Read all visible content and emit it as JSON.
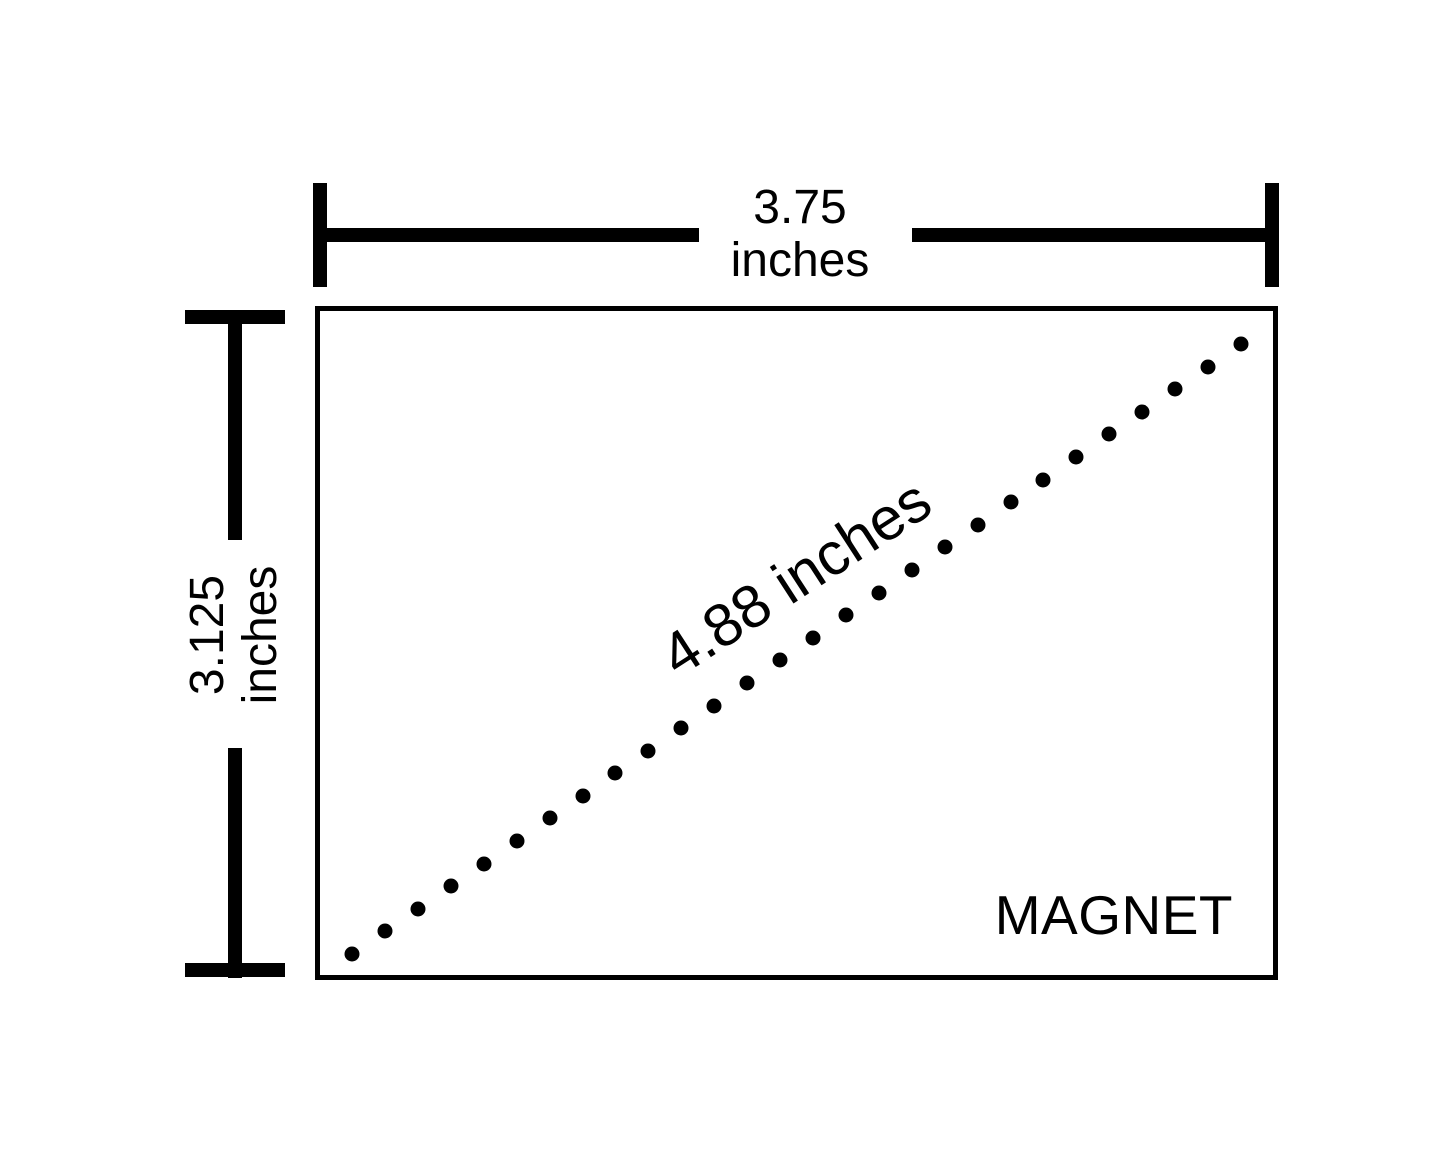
{
  "diagram": {
    "object_label": "MAGNET",
    "width_dimension": {
      "value": "3.75",
      "unit": "inches"
    },
    "height_dimension": {
      "value": "3.125",
      "unit": "inches"
    },
    "diagonal_dimension": {
      "label": "4.88 inches"
    },
    "diagonal_dots": {
      "count": 28
    },
    "colors": {
      "ink": "#000000",
      "background": "#ffffff"
    }
  }
}
